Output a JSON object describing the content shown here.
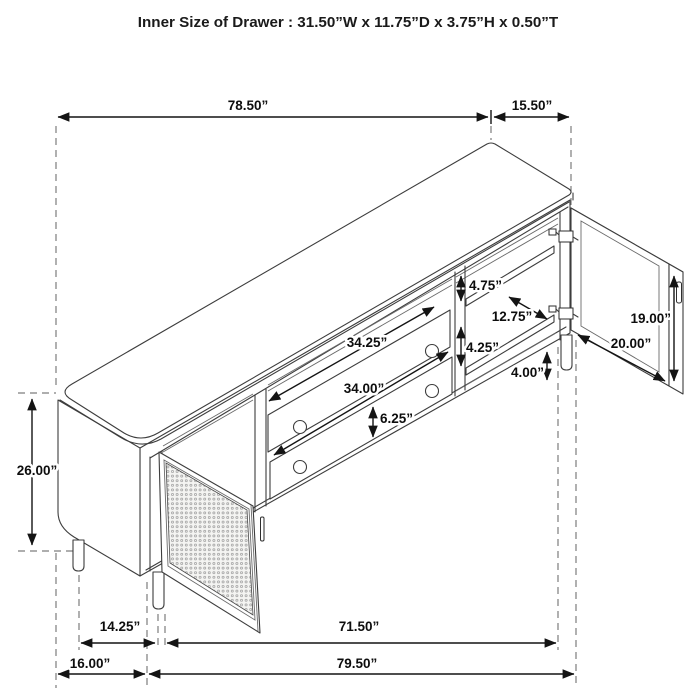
{
  "title": "Inner Size of Drawer : 31.50”W x 11.75”D x 3.75”H x 0.50”T",
  "dims": {
    "overall_width": "78.50”",
    "side_depth": "15.50”",
    "overall_height": "26.00”",
    "top_shelf_gap": "4.75”",
    "shelf_depth": "12.75”",
    "middle_shelf_gap": "4.25”",
    "leg_height": "4.00”",
    "door_glass_height": "19.00”",
    "door_width": "20.00”",
    "drawer_opening_top": "34.25”",
    "drawer_opening_bottom": "34.00”",
    "drawer_front_height": "6.25”",
    "left_leg_inset": "14.25”",
    "base_span": "71.50”",
    "left_section_depth": "16.00”",
    "base_overall_width": "79.50”"
  },
  "colors": {
    "line": "#3d3d3d",
    "dimension": "#141414",
    "dashed": "#7d7d7d",
    "background": "#ffffff"
  }
}
